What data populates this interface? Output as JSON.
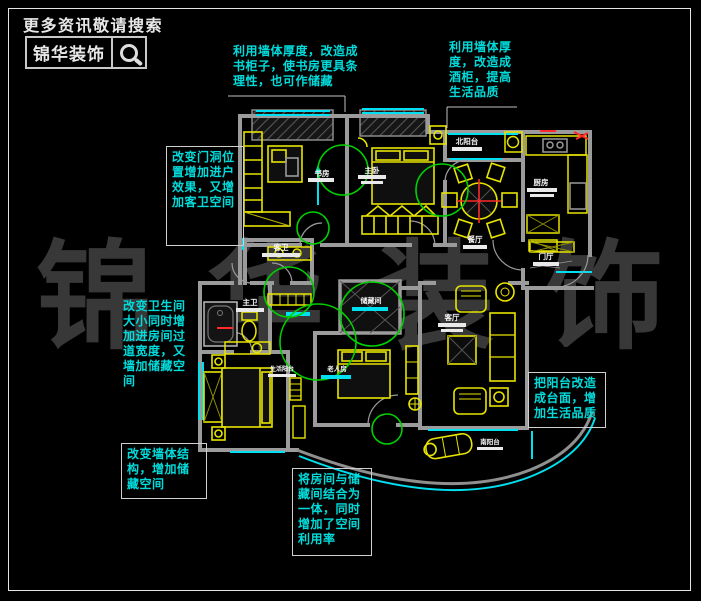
{
  "branding": {
    "search_hint": "更多资讯敬请搜索",
    "brand_name": "锦华装饰",
    "search_icon": "magnifier-icon",
    "watermark": [
      "锦",
      "华",
      "装",
      "饰"
    ]
  },
  "colors": {
    "background": "#000000",
    "wall": "#9b9b9b",
    "furniture": "#e8e400",
    "window": "#00e0f0",
    "annotation_circle": "#00d000",
    "highlight_red": "#ff2a2a",
    "callout_text": "#00dcdc",
    "room_label": "#f5f5f5",
    "watermark": "#383838"
  },
  "rooms": [
    {
      "id": "study",
      "label": "书房"
    },
    {
      "id": "master-bedroom",
      "label": "主卧"
    },
    {
      "id": "north-balcony",
      "label": "北阳台"
    },
    {
      "id": "dining",
      "label": "餐厅"
    },
    {
      "id": "kitchen",
      "label": "厨房"
    },
    {
      "id": "foyer",
      "label": "门厅"
    },
    {
      "id": "guest-bath",
      "label": "客卫"
    },
    {
      "id": "master-bath",
      "label": "主卫"
    },
    {
      "id": "storage",
      "label": "储藏间"
    },
    {
      "id": "living-balcony",
      "label": "生活阳台"
    },
    {
      "id": "elder-room",
      "label": "老人房"
    },
    {
      "id": "living-room",
      "label": "客厅"
    },
    {
      "id": "south-balcony",
      "label": "南阳台"
    }
  ],
  "callouts": [
    {
      "id": "study-bookcase",
      "lines": [
        "利用墙体厚度，改造成",
        "书柜子，使书房更具条",
        "理性，也可作储藏"
      ]
    },
    {
      "id": "wine-cabinet",
      "lines": [
        "利用墙体厚",
        "度，改造成",
        "酒柜，提高",
        "生活品质"
      ]
    },
    {
      "id": "door-opening",
      "lines": [
        "改变门洞位",
        "置增加进户",
        "效果，又增",
        "加客卫空间"
      ]
    },
    {
      "id": "bathroom-resize",
      "lines": [
        "改变卫生间",
        "大小同时增",
        "加进房间过",
        "道宽度，又",
        "墙加储藏空",
        "间"
      ]
    },
    {
      "id": "wall-structure",
      "lines": [
        "改变墙体结",
        "构，增加储",
        "藏空间"
      ]
    },
    {
      "id": "room-storage-merge",
      "lines": [
        "将房间与储",
        "藏间结合为",
        "一体，同时",
        "增加了空间",
        "利用率"
      ]
    },
    {
      "id": "balcony-counter",
      "lines": [
        "把阳台改造",
        "成台面，增",
        "加生活品质"
      ]
    }
  ]
}
